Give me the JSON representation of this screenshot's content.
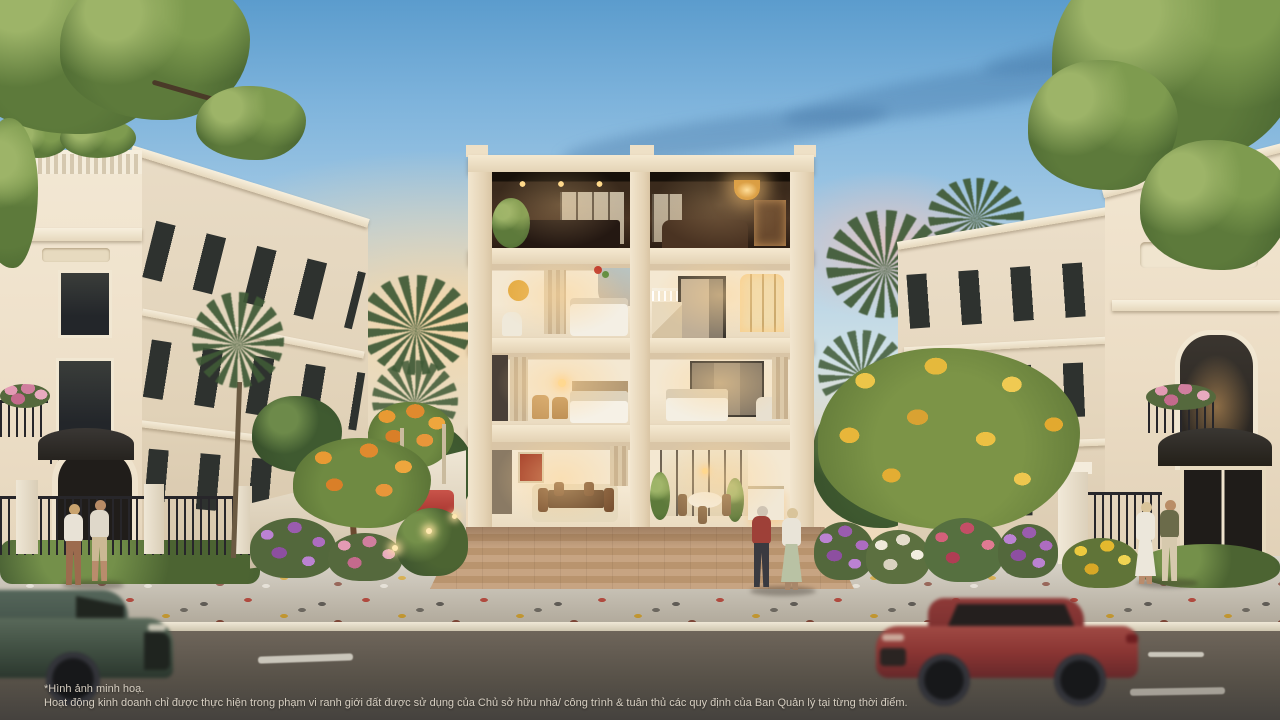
{
  "disclaimer": {
    "line1": "*Hình ảnh minh hoạ.",
    "line2": "Hoạt động kinh doanh chỉ được thực hiện trong phạm vi ranh giới đất được sử dụng của Chủ sở hữu nhà/ công trình & tuân thủ các quy định của Ban Quản lý tại từng thời điểm."
  },
  "palette": {
    "sky_top": "#5b9ccd",
    "sky_horizon_glow": "#f4ddb4",
    "facade_cream": "#eee0c9",
    "window_glass_dark": "#2e322f",
    "interior_warm_light": "#ffd98a",
    "top_floor_wood": "#4a3423",
    "courtyard_paver": "#c09b77",
    "sidewalk": "#ccc5b6",
    "road_asphalt": "#575148",
    "curb": "#efe8d6",
    "suv_red": "#8a3533",
    "car_green": "#3f4e41",
    "flower_purple": "#9a5cae",
    "flower_pink": "#d07e9e",
    "flower_yellow": "#e3b92e",
    "flower_orange": "#e08a2e",
    "foliage_green": "#5d7a3b",
    "lane_marking": "#ddd9ce"
  }
}
